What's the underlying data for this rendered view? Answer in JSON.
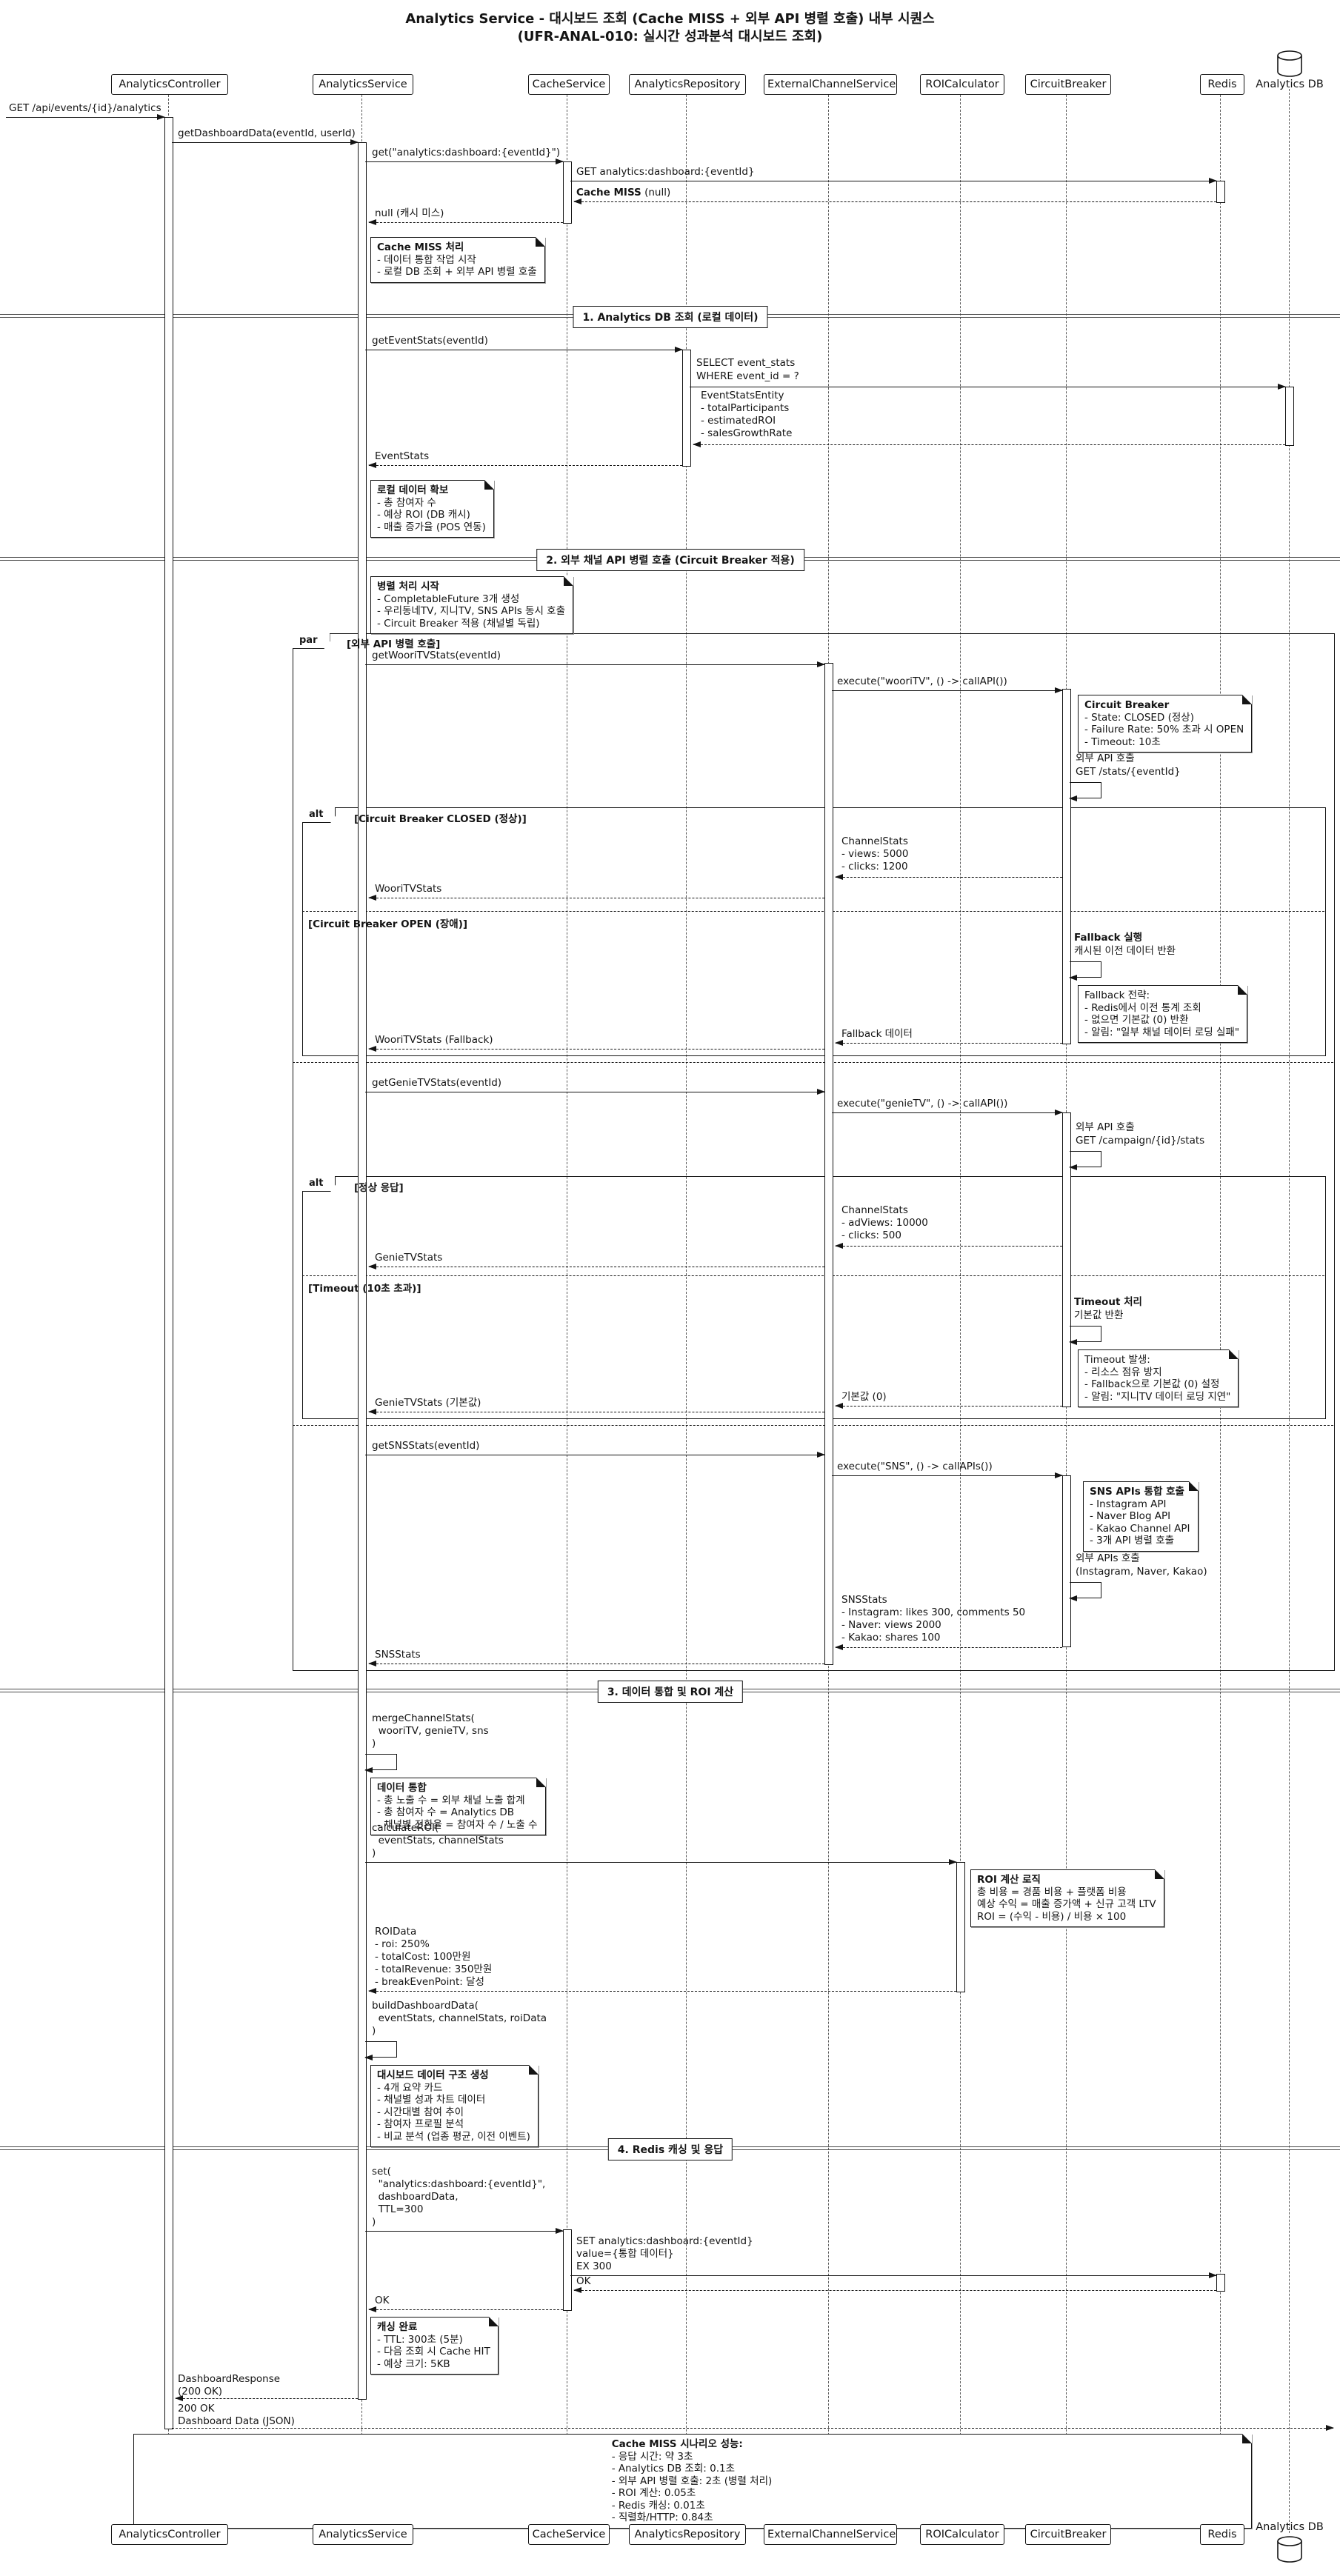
{
  "title": {
    "line1": "Analytics Service - 대시보드 조회 (Cache MISS + 외부 API 병렬 호출) 내부 시퀀스",
    "line2": "(UFR-ANAL-010: 실시간 성과분석 대시보드 조회)"
  },
  "participants": {
    "controller": "AnalyticsController",
    "service": "AnalyticsService",
    "cache": "CacheService",
    "repository": "AnalyticsRepository",
    "external": "ExternalChannelService",
    "roi": "ROICalculator",
    "breaker": "CircuitBreaker",
    "redis": "Redis",
    "db": "Analytics DB"
  },
  "dividers": {
    "d1": "1. Analytics DB 조회 (로컬 데이터)",
    "d2": "2. 외부 채널 API 병렬 호출 (Circuit Breaker 적용)",
    "d3": "3. 데이터 통합 및 ROI 계산",
    "d4": "4. Redis 캐싱 및 응답"
  },
  "frames": {
    "par": {
      "keyword": "par",
      "condition": "[외부 API 병렬 호출]"
    },
    "alt_breaker": {
      "keyword": "alt",
      "condition": "[Circuit Breaker CLOSED (정상)]",
      "else_condition": "[Circuit Breaker OPEN (장애)]"
    },
    "alt_genie": {
      "keyword": "alt",
      "condition": "[정상 응답]",
      "else_condition": "[Timeout (10초 초과)]"
    }
  },
  "messages": {
    "client_request": "GET /api/events/{id}/analytics",
    "get_dashboard": "getDashboardData(eventId, userId)",
    "cache_get": "get(\"analytics:dashboard:{eventId}\")",
    "redis_get": "GET analytics:dashboard:{eventId}",
    "cache_miss": {
      "bold": "Cache MISS",
      "rest": " (null)"
    },
    "null_return": "null (캐시 미스)",
    "get_event_stats": "getEventStats(eventId)",
    "select_query": [
      "SELECT event_stats",
      "WHERE event_id = ?"
    ],
    "entity_return": [
      "EventStatsEntity",
      "- totalParticipants",
      "- estimatedROI",
      "- salesGrowthRate"
    ],
    "event_stats_return": "EventStats",
    "get_woori": "getWooriTVStats(eventId)",
    "execute_woori": "execute(\"wooriTV\", () -> callAPI())",
    "woori_api": [
      "외부 API 호출",
      "GET /stats/{eventId}"
    ],
    "woori_stats": [
      "ChannelStats",
      "- views: 5000",
      "- clicks: 1200"
    ],
    "woori_return": "WooriTVStats",
    "fallback_exec": [
      "Fallback 실행",
      "캐시된 이전 데이터 반환"
    ],
    "fallback_data": "Fallback 데이터",
    "woori_fallback": "WooriTVStats (Fallback)",
    "get_genie": "getGenieTVStats(eventId)",
    "execute_genie": "execute(\"genieTV\", () -> callAPI())",
    "genie_api": [
      "외부 API 호출",
      "GET /campaign/{id}/stats"
    ],
    "genie_stats": [
      "ChannelStats",
      "- adViews: 10000",
      "- clicks: 500"
    ],
    "genie_return": "GenieTVStats",
    "timeout_exec": [
      "Timeout 처리",
      "기본값 반환"
    ],
    "default_return": "기본값 (0)",
    "genie_default": "GenieTVStats (기본값)",
    "get_sns": "getSNSStats(eventId)",
    "execute_sns": "execute(\"SNS\", () -> callAPIs())",
    "sns_api": [
      "외부 APIs 호출",
      "(Instagram, Naver, Kakao)"
    ],
    "sns_stats": [
      "SNSStats",
      "- Instagram: likes 300, comments 50",
      "- Naver: views 2000",
      "- Kakao: shares 100"
    ],
    "sns_return": "SNSStats",
    "merge": [
      "mergeChannelStats(",
      "  wooriTV, genieTV, sns",
      ")"
    ],
    "calc_roi": [
      "calculateROI(",
      "  eventStats, channelStats",
      ")"
    ],
    "roi_data": [
      "ROIData",
      "- roi: 250%",
      "- totalCost: 100만원",
      "- totalRevenue: 350만원",
      "- breakEvenPoint: 달성"
    ],
    "build": [
      "buildDashboardData(",
      "  eventStats, channelStats, roiData",
      ")"
    ],
    "set_cache": [
      "set(",
      "  \"analytics:dashboard:{eventId}\",",
      "  dashboardData,",
      "  TTL=300",
      ")"
    ],
    "set_redis": [
      "SET analytics:dashboard:{eventId}",
      "value={통합 데이터}",
      "EX 300"
    ],
    "ok_redis": "OK",
    "ok_cache": "OK",
    "dash_response": [
      "DashboardResponse",
      "(200 OK)"
    ],
    "final_response": [
      "200 OK",
      "Dashboard Data (JSON)"
    ]
  },
  "notes": {
    "cache_miss": {
      "title": "Cache MISS 처리",
      "lines": [
        "- 데이터 통합 작업 시작",
        "- 로컬 DB 조회 + 외부 API 병렬 호출"
      ]
    },
    "local_data": {
      "title": "로컬 데이터 확보",
      "lines": [
        "- 총 참여자 수",
        "- 예상 ROI (DB 캐시)",
        "- 매출 증가율 (POS 연동)"
      ]
    },
    "parallel_start": {
      "title": "병렬 처리 시작",
      "lines": [
        "- CompletableFuture 3개 생성",
        "- 우리동네TV, 지니TV, SNS APIs 동시 호출",
        "- Circuit Breaker 적용 (채널별 독립)"
      ]
    },
    "circuit_breaker": {
      "title": "Circuit Breaker",
      "lines": [
        "- State: CLOSED (정상)",
        "- Failure Rate: 50% 초과 시 OPEN",
        "- Timeout: 10초"
      ]
    },
    "fallback_strategy": {
      "title": "Fallback 전략:",
      "lines": [
        "- Redis에서 이전 통계 조회",
        "- 없으면 기본값 (0) 반환",
        "- 알림: \"일부 채널 데이터 로딩 실패\""
      ]
    },
    "timeout_occur": {
      "title": "Timeout 발생:",
      "lines": [
        "- 리소스 점유 방지",
        "- Fallback으로 기본값 (0) 설정",
        "- 알림: \"지니TV 데이터 로딩 지연\""
      ]
    },
    "sns_apis": {
      "title": "SNS APIs 통합 호출",
      "lines": [
        "- Instagram API",
        "- Naver Blog API",
        "- Kakao Channel API",
        "- 3개 API 병렬 호출"
      ]
    },
    "data_merge": {
      "title": "데이터 통합",
      "lines": [
        "- 총 노출 수 = 외부 채널 노출 합계",
        "- 총 참여자 수 = Analytics DB",
        "- 채널별 전환율 = 참여자 수 / 노출 수"
      ]
    },
    "roi_logic": {
      "title": "ROI 계산 로직",
      "lines": [
        "총 비용 = 경품 비용 + 플랫폼 비용",
        "예상 수익 = 매출 증가액 + 신규 고객 LTV",
        "ROI = (수익 - 비용) / 비용 × 100"
      ]
    },
    "dashboard_build": {
      "title": "대시보드 데이터 구조 생성",
      "lines": [
        "- 4개 요약 카드",
        "- 채널별 성과 차트 데이터",
        "- 시간대별 참여 추이",
        "- 참여자 프로필 분석",
        "- 비교 분석 (업종 평균, 이전 이벤트)"
      ]
    },
    "caching_done": {
      "title": "캐싱 완료",
      "lines": [
        "- TTL: 300초 (5분)",
        "- 다음 조회 시 Cache HIT",
        "- 예상 크기: 5KB"
      ]
    },
    "performance": {
      "title": "Cache MISS 시나리오 성능:",
      "lines": [
        "- 응답 시간: 약 3초",
        "- Analytics DB 조회: 0.1초",
        "- 외부 API 병렬 호출: 2초 (병렬 처리)",
        "- ROI 계산: 0.05초",
        "- Redis 캐싱: 0.01초",
        "- 직렬화/HTTP: 0.84초"
      ]
    }
  }
}
